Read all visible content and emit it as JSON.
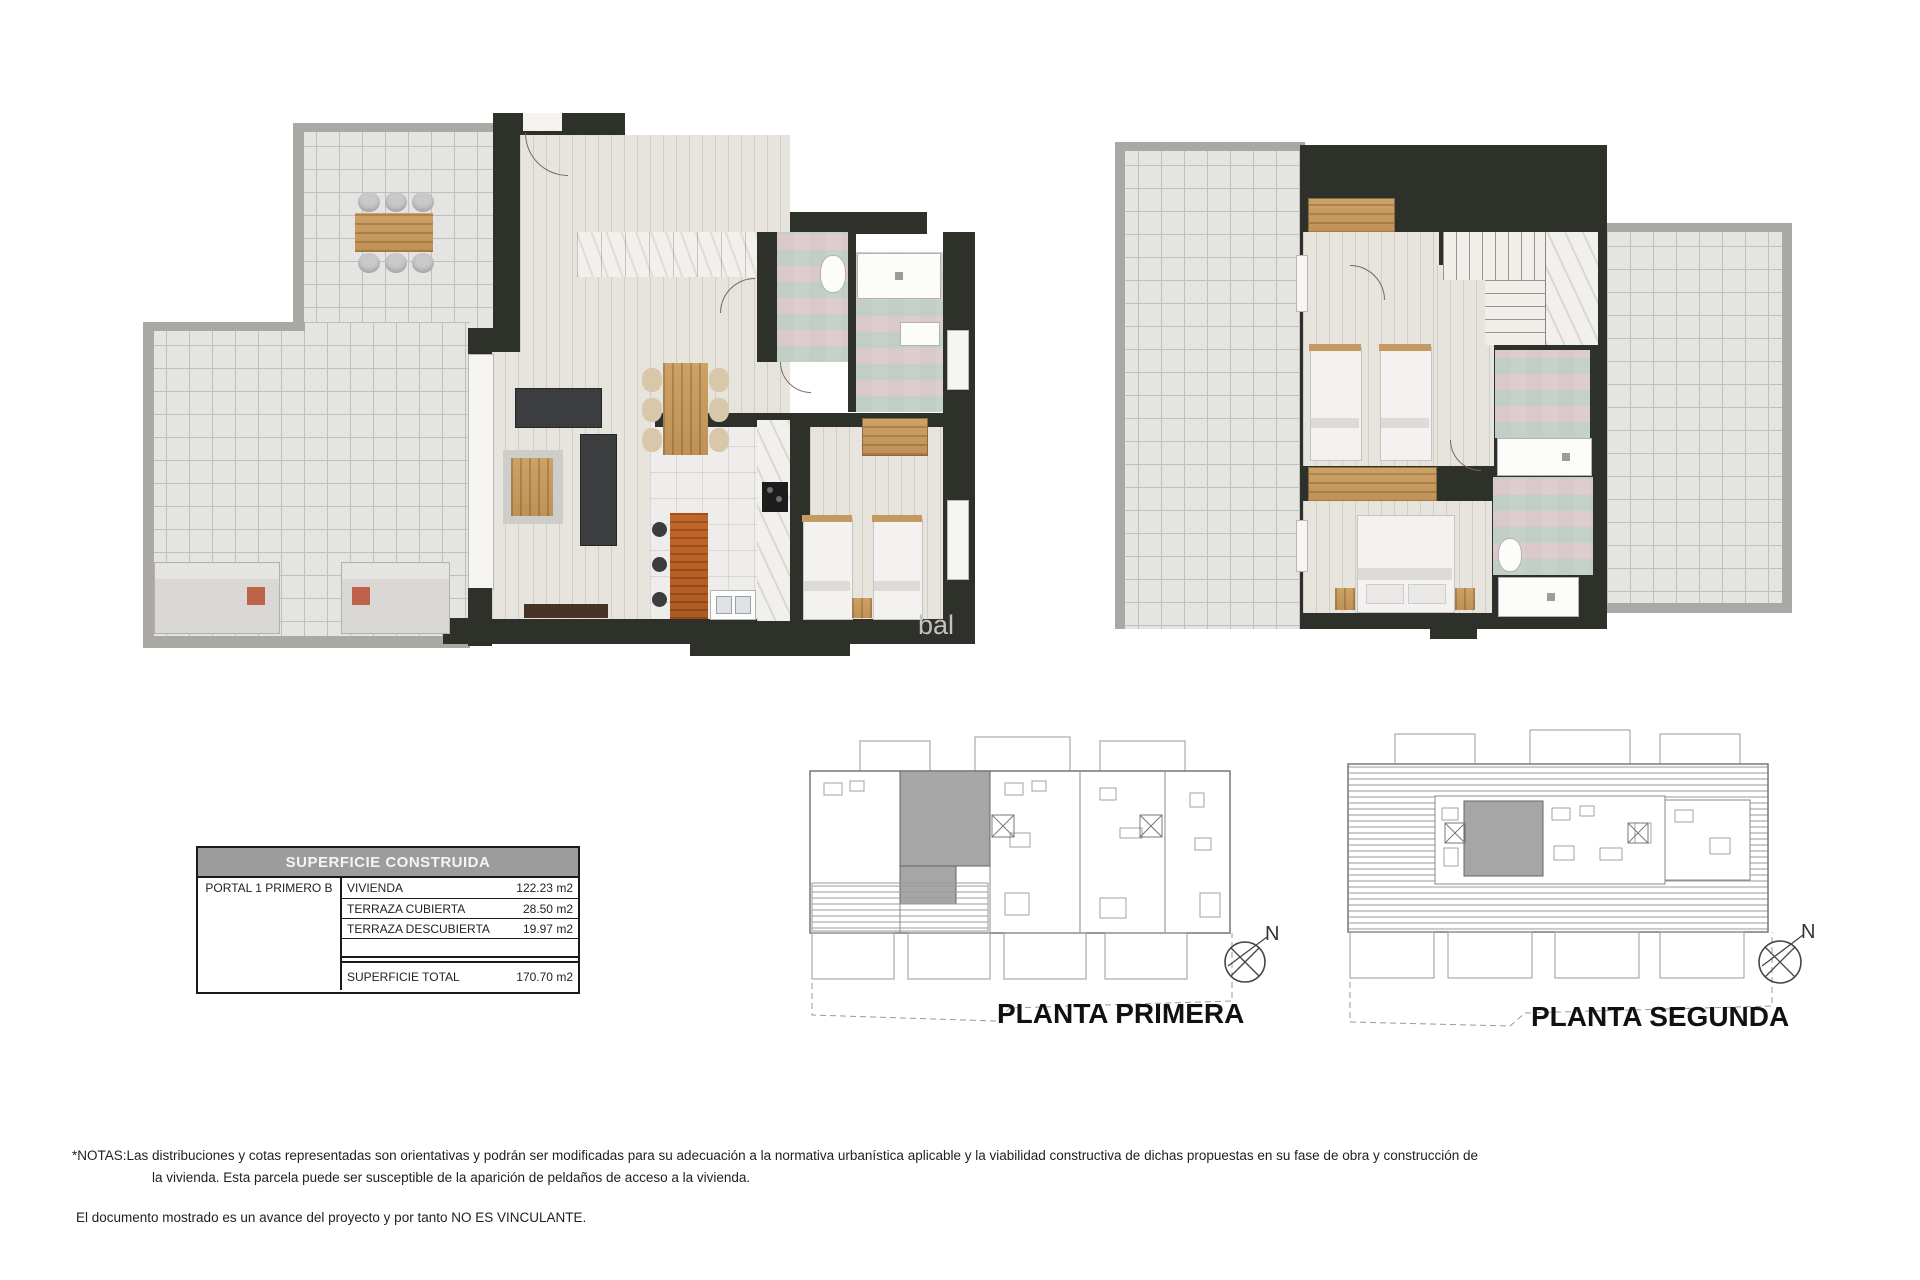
{
  "document": {
    "watermark": "bal",
    "surface_table": {
      "title": "SUPERFICIE CONSTRUIDA",
      "portal": "PORTAL 1 PRIMERO B",
      "rows": [
        {
          "label": "VIVIENDA",
          "value": "122.23 m2"
        },
        {
          "label": "TERRAZA CUBIERTA",
          "value": "28.50 m2"
        },
        {
          "label": "TERRAZA DESCUBIERTA",
          "value": "19.97 m2"
        }
      ],
      "total": {
        "label": "SUPERFICIE TOTAL",
        "value": "170.70 m2"
      }
    },
    "site_plans": [
      {
        "label": "PLANTA PRIMERA",
        "compass": "N"
      },
      {
        "label": "PLANTA SEGUNDA",
        "compass": "N"
      }
    ],
    "notes": {
      "line1": "*NOTAS:Las distribuciones y cotas representadas son orientativas y podrán ser modificadas para su adecuación a la normativa urbanística aplicable y la viabilidad constructiva de dichas propuestas en su fase de obra y construcción de",
      "line2": "la vivienda. Esta parcela puede ser susceptible de la aparición de peldaños de acceso a la vivienda.",
      "line3": "El documento mostrado es un avance del proyecto y por tanto NO ES VINCULANTE."
    },
    "colors": {
      "wall": "#2e302a",
      "terrace_tile": "#e4e4e3",
      "interior_floor": "#e7e3dd",
      "wood": "#cda266",
      "kitchen_island": "#b86226",
      "mosaic_teal": "#98bcb2",
      "mosaic_mauve": "#c6a8b4",
      "site_highlight": "#a6a6a6",
      "table_header": "#9c9c9c"
    }
  }
}
